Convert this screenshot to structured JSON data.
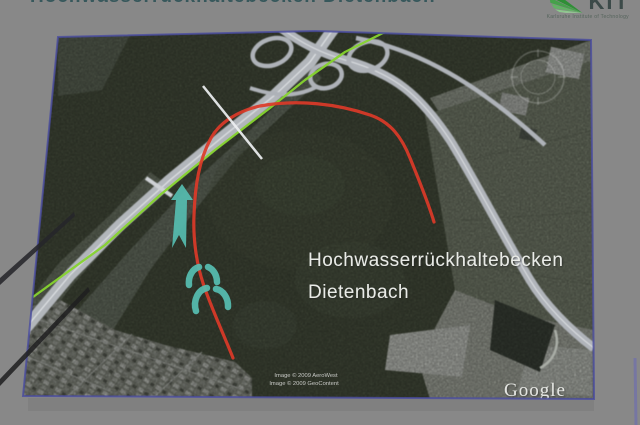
{
  "slide": {
    "title": "Hochwasserrückhaltebecken Dietenbach",
    "logo": {
      "acronym": "KIT",
      "subtitle": "Karlsruhe Institute of Technology"
    }
  },
  "map": {
    "label": {
      "line1": "Hochwasserrückhaltebecken",
      "line2": "Dietenbach"
    },
    "credits": {
      "line1": "Image © 2009 AeroWest",
      "line2": "Image © 2009 GeoContent"
    },
    "watermark": "Google",
    "colors": {
      "basin_outline": "#dc3a28",
      "route_line": "#86d42e",
      "flow_arrow": "#56bdb0",
      "dam_symbol": "#57bfb2",
      "dam_axis": "#eef0f2",
      "map_border": "#4a4ca0"
    }
  }
}
